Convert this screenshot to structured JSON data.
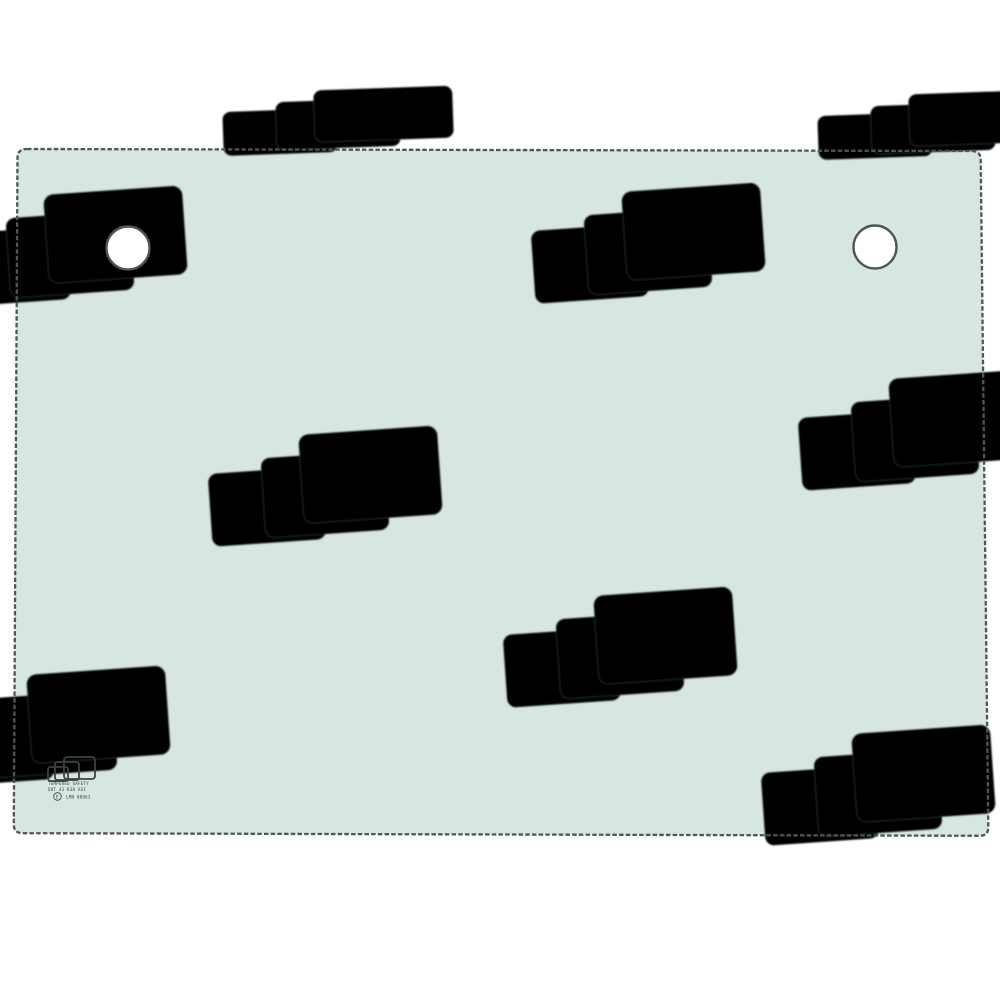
{
  "colors": {
    "background": "#ffffff",
    "glass_fill": "#d7e6e0",
    "glass_edge": "#4f5754",
    "watermark_stroke": "rgba(104,122,114,0.30)",
    "stamp_ink": "#3c423f"
  },
  "stamp": {
    "line1": "TEMPERED SAFETY",
    "line2": "DOT 43 R38 AS1",
    "e_mark": "E",
    "line3": "LMN 00963"
  }
}
